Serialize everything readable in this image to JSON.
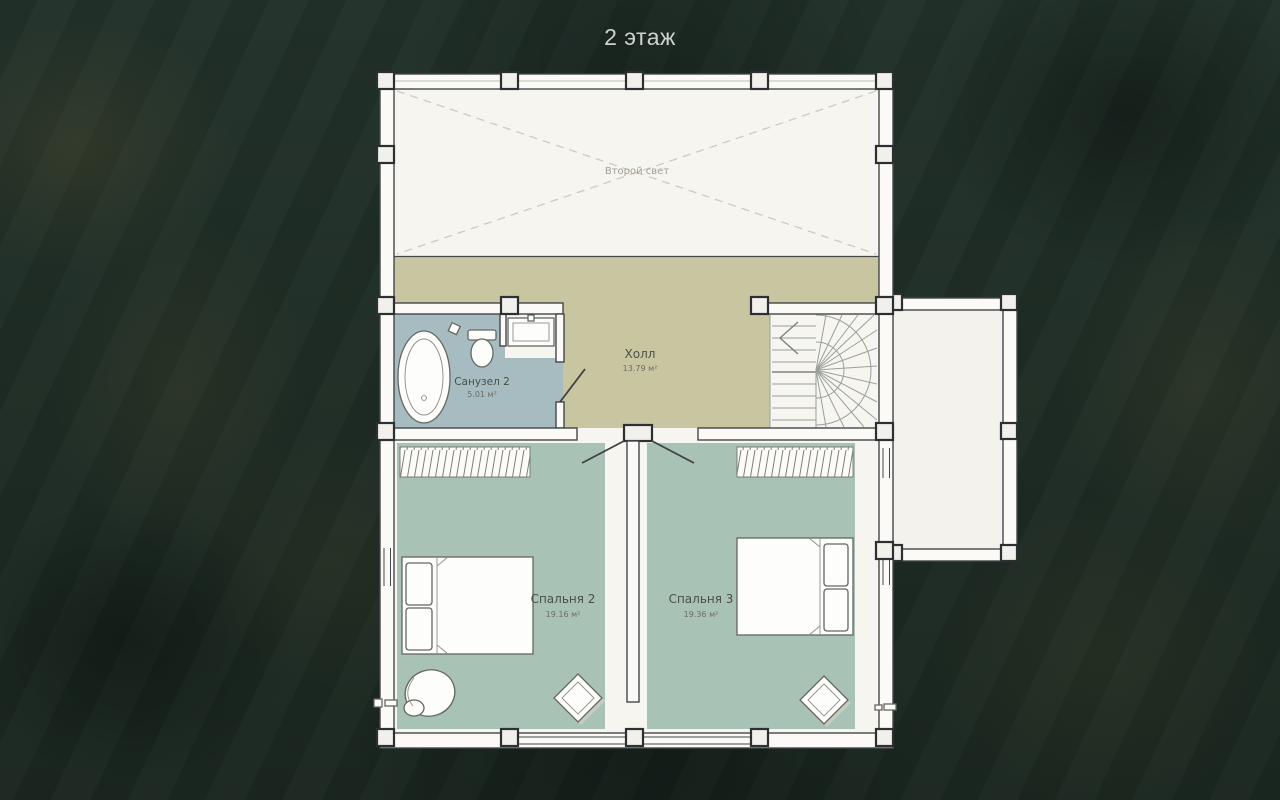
{
  "page": {
    "title": "2 этаж"
  },
  "plan": {
    "rooms": {
      "second_light": {
        "name": "Второй свет"
      },
      "hall": {
        "name": "Холл",
        "area": "13.79 м²"
      },
      "bathroom": {
        "name": "Санузел 2",
        "area": "5.01 м²"
      },
      "bedroom_2": {
        "name": "Спальня 2",
        "area": "19.16 м²"
      },
      "bedroom_3": {
        "name": "Спальня 3",
        "area": "19.36 м²"
      }
    },
    "symbols": [
      "bathtub",
      "toilet",
      "sink",
      "staircase",
      "double-bed",
      "wardrobe-hatch",
      "armchair",
      "side-table",
      "door-swing",
      "balcony",
      "window",
      "pillar"
    ],
    "colors": {
      "background": "#1f2d25",
      "floor_base": "#f6f5f0",
      "hall_floor": "#c7c6a1",
      "bathroom_floor": "#a7bcc1",
      "bedroom_floor": "#a9c2b6",
      "wall_outline": "#43464a",
      "title_text": "#ccd3cd"
    }
  }
}
